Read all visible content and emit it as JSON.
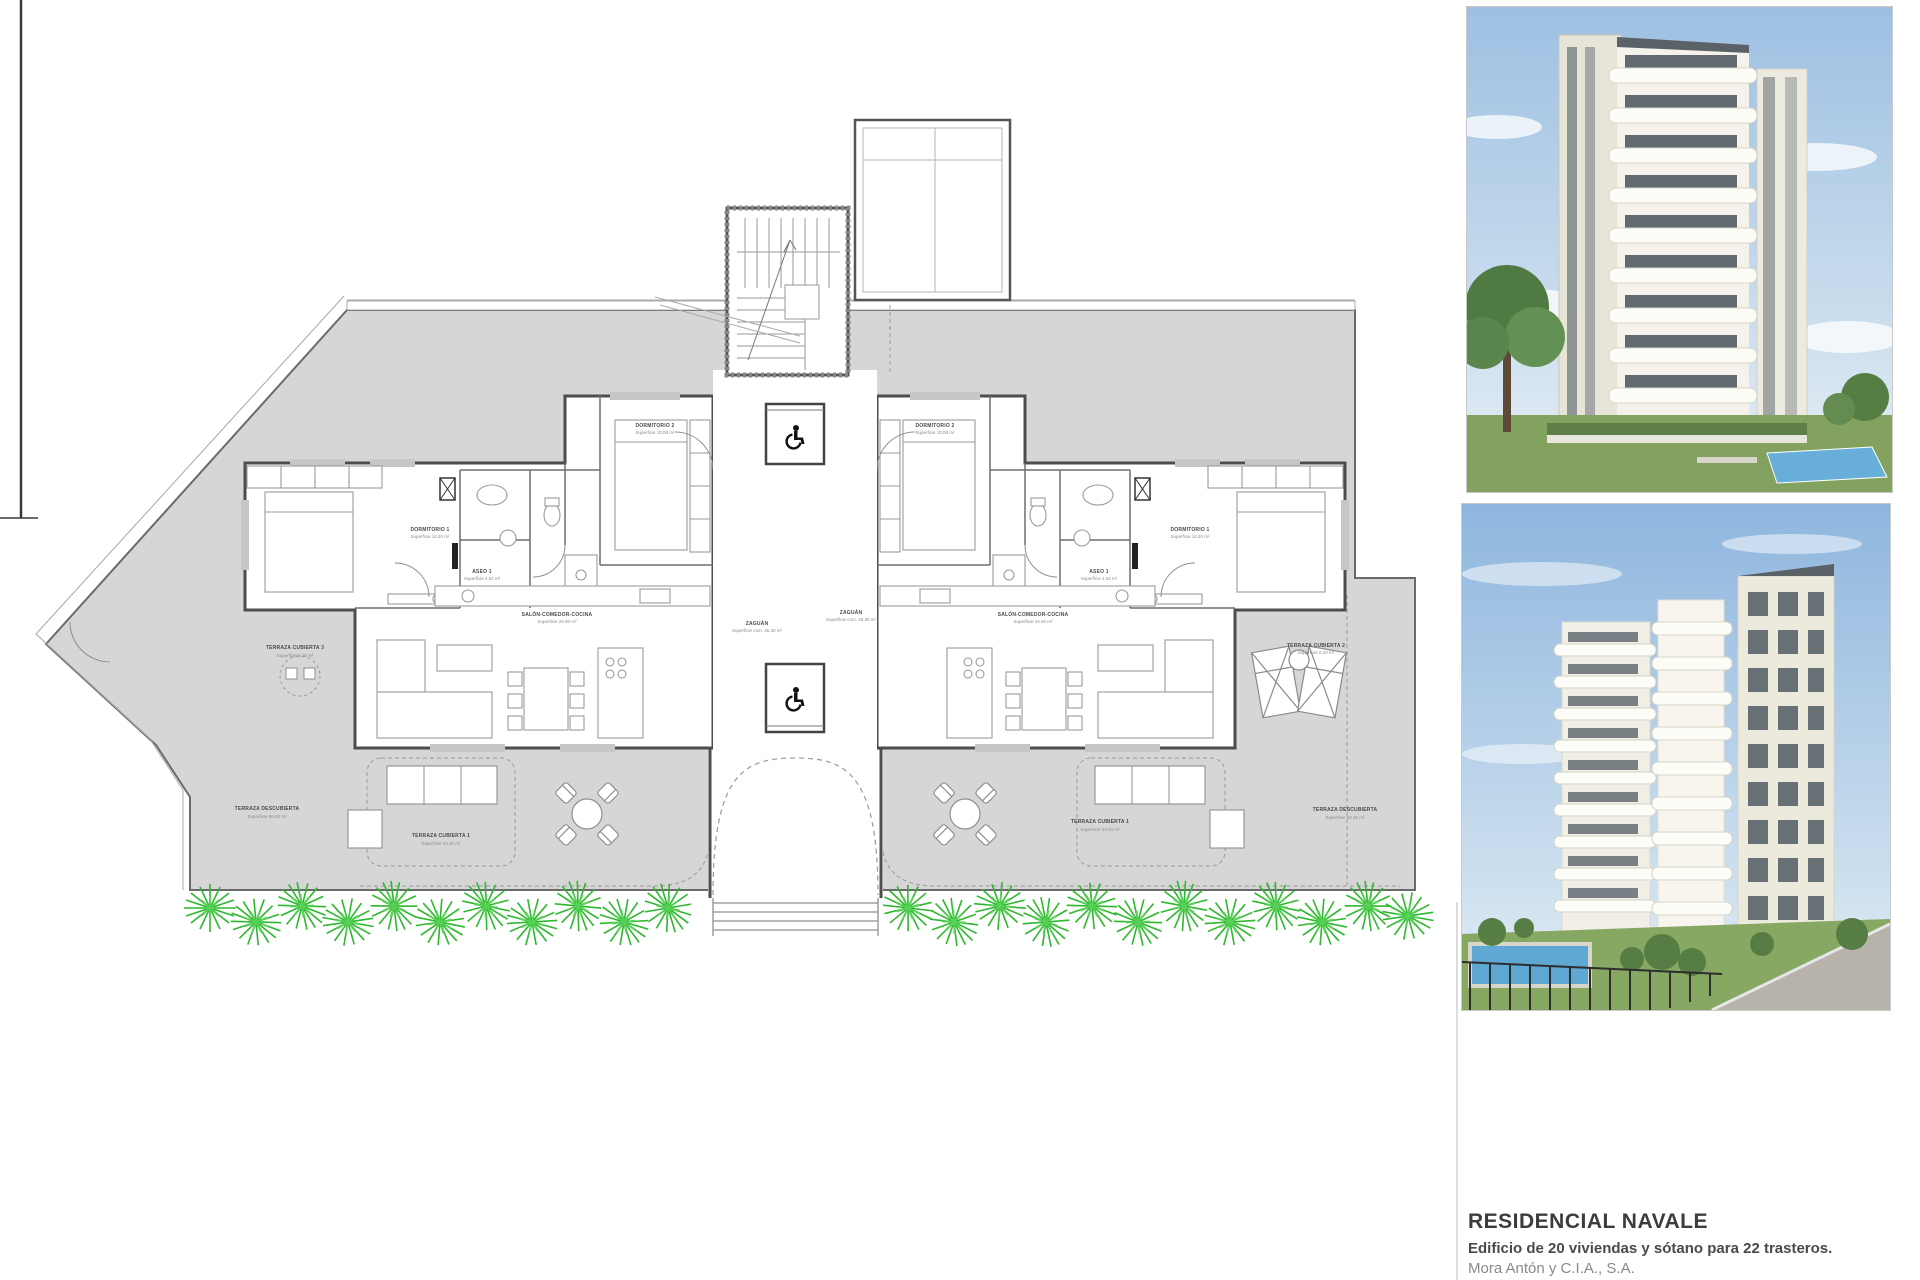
{
  "plan": {
    "labels": {
      "tc3": {
        "name": "TERRAZA CUBIERTA 3",
        "area": "Superficie 6.15 m²"
      },
      "tdL": {
        "name": "TERRAZA DESCUBIERTA",
        "area": "Superficie 86.00 m²"
      },
      "d1L": {
        "name": "DORMITORIO 1",
        "area": "Superficie 14.40 m²"
      },
      "a1L": {
        "name": "ASEO 1",
        "area": "Superficie 4.62 m²"
      },
      "d2L": {
        "name": "DORMITORIO 2",
        "area": "Superficie 10.08 m²"
      },
      "salL": {
        "name": "SALÓN-COMEDOR-COCINA",
        "area": "Superficie 24.60 m²"
      },
      "tc1L": {
        "name": "TERRAZA CUBIERTA 1",
        "area": "Superficie 23.40 m²"
      },
      "zagL": {
        "name": "ZAGUÁN",
        "area": "Superficie com. 45.30 m²"
      },
      "zagR": {
        "name": "ZAGUÁN",
        "area": "Superficie com. 45.30 m²"
      },
      "d2R": {
        "name": "DORMITORIO 2",
        "area": "Superficie 10.08 m²"
      },
      "a1R": {
        "name": "ASEO 1",
        "area": "Superficie 4.62 m²"
      },
      "d1R": {
        "name": "DORMITORIO 1",
        "area": "Superficie 14.40 m²"
      },
      "salR": {
        "name": "SALÓN-COMEDOR-COCINA",
        "area": "Superficie 24.60 m²"
      },
      "tc1R": {
        "name": "TERRAZA CUBIERTA 1",
        "area": "Superficie 23.40 m²"
      },
      "tc2": {
        "name": "TERRAZA CUBIERTA 2",
        "area": "Superficie 9.20 m²"
      },
      "tdR": {
        "name": "TERRAZA DESCUBIERTA",
        "area": "Superficie 94.35 m²"
      }
    },
    "colors": {
      "terrace_fill": "#d6d6d6",
      "wall": "#555555",
      "plant_green": "#2db82d"
    }
  },
  "footer": {
    "title": "RESIDENCIAL NAVALE",
    "subtitle": "Edificio de 20 viviendas y sótano para 22 trasteros.",
    "company": "Mora Antón y C.I.A., S.A.",
    "address": "Avenida del Puerto esq/con Calle Maestro González Hombrados"
  }
}
